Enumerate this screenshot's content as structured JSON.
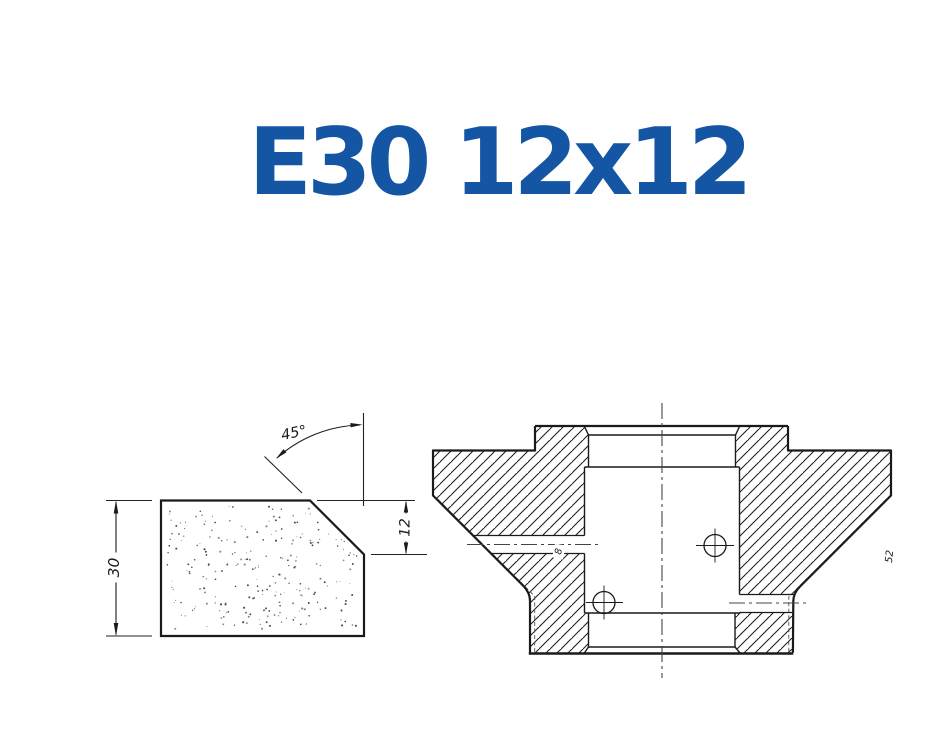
{
  "title": {
    "text": "E30 12x12",
    "color": "#1556A4"
  },
  "left_view": {
    "description": "abrasive segment profile view",
    "dimensions": {
      "height": {
        "value": "30"
      },
      "chamfer_depth": {
        "value": "12"
      },
      "chamfer_angle": {
        "value": "45°"
      }
    }
  },
  "right_view": {
    "description": "wheel cross-section view",
    "labels": {
      "cross_hole": "8",
      "side_dimension": "52"
    }
  },
  "drawing": {
    "line_color": "#1a1a1a",
    "centerline_color": "#444444",
    "thin_layer_color": "#555555",
    "stipple_color": "#4a4a4a"
  }
}
